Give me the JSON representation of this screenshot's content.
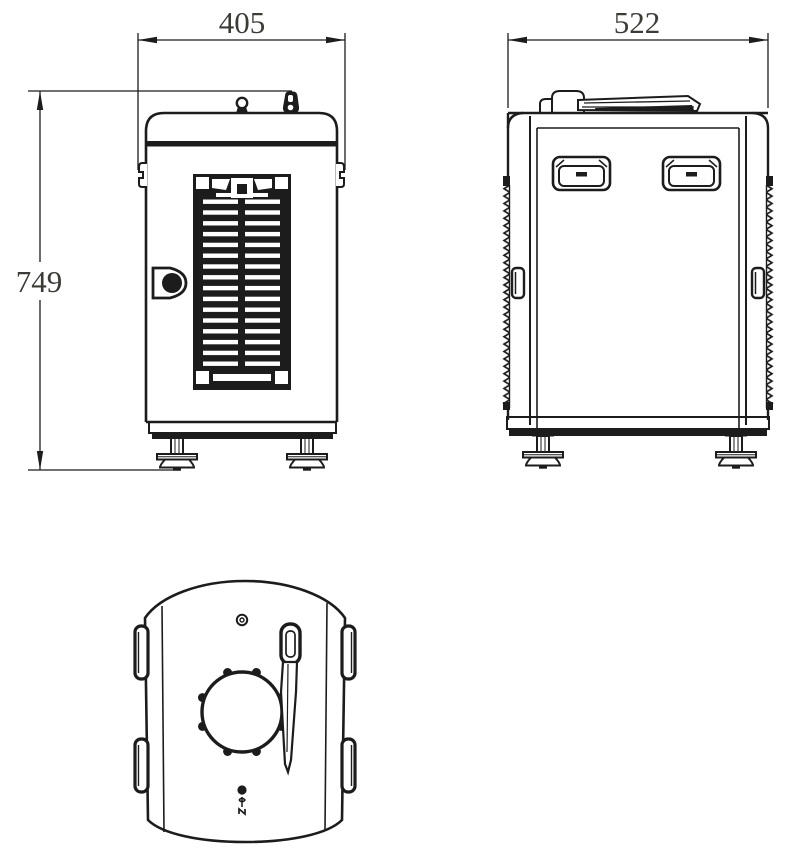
{
  "drawing": {
    "description": "three-view technical drawing of equipment enclosure",
    "views": [
      "front",
      "side",
      "top"
    ],
    "dimensions": {
      "front_width": "405",
      "front_height": "749",
      "side_width": "522"
    },
    "colors": {
      "line": "#1c1c1c",
      "dim_text": "#3c3c36",
      "background": "#ffffff"
    }
  }
}
